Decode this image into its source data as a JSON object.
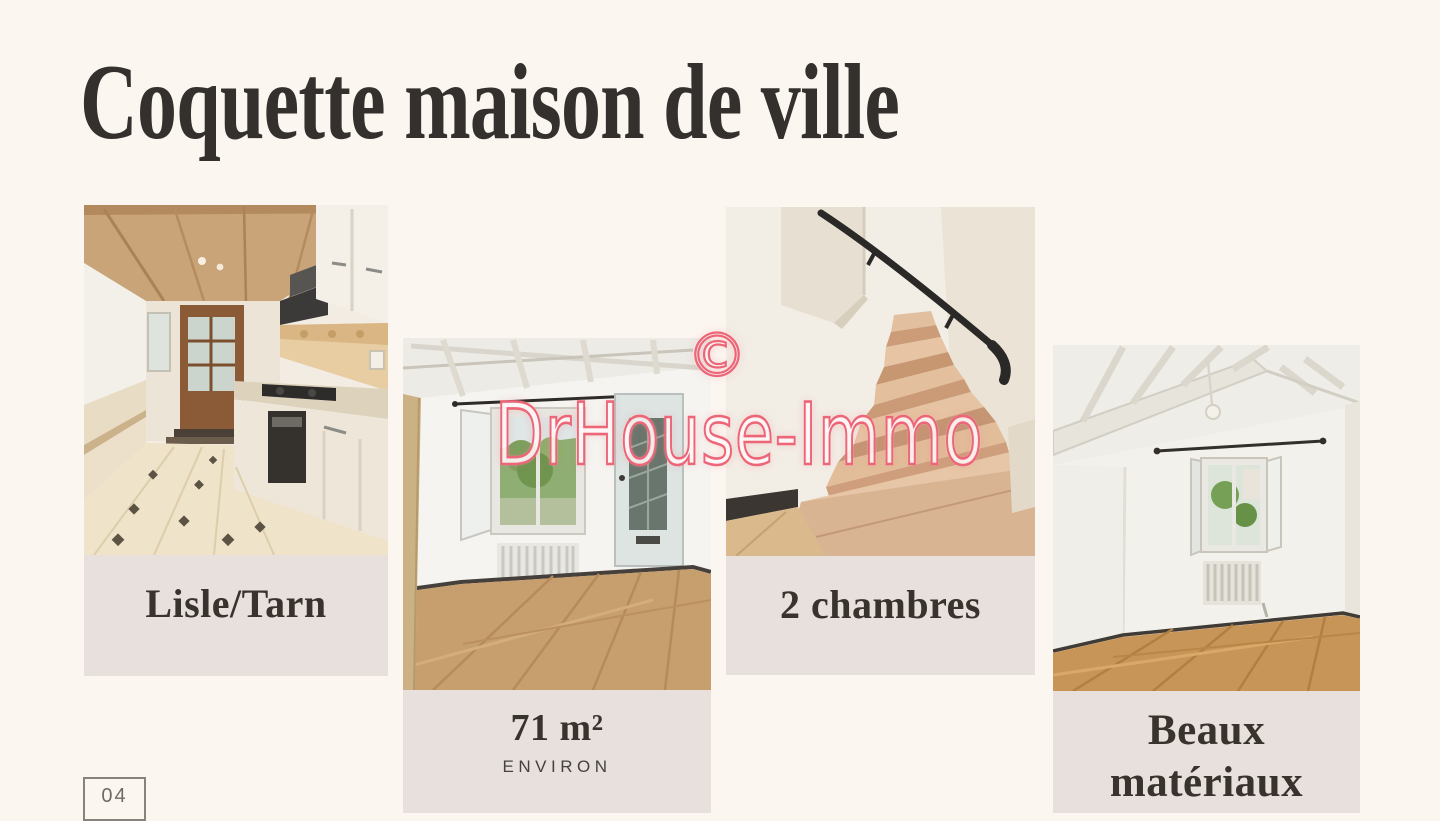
{
  "page": {
    "title": "Coquette maison de ville",
    "page_number": "04"
  },
  "watermark": {
    "symbol": "©",
    "text": "DrHouse-Immo",
    "color": "#ec6677"
  },
  "cards": [
    {
      "name": "kitchen",
      "caption": "Lisle/Tarn"
    },
    {
      "name": "living-room",
      "caption": "71 m²",
      "subcaption": "ENVIRON"
    },
    {
      "name": "staircase",
      "caption": "2 chambres"
    },
    {
      "name": "bedroom",
      "caption": "Beaux matériaux"
    }
  ],
  "colors": {
    "background": "#fcf6f0",
    "caption_block": "#e8e0dc",
    "title_text": "#33302d",
    "caption_text": "#39332d",
    "watermark_pink": "#ec6677",
    "page_number_gray": "#6f6b64"
  }
}
